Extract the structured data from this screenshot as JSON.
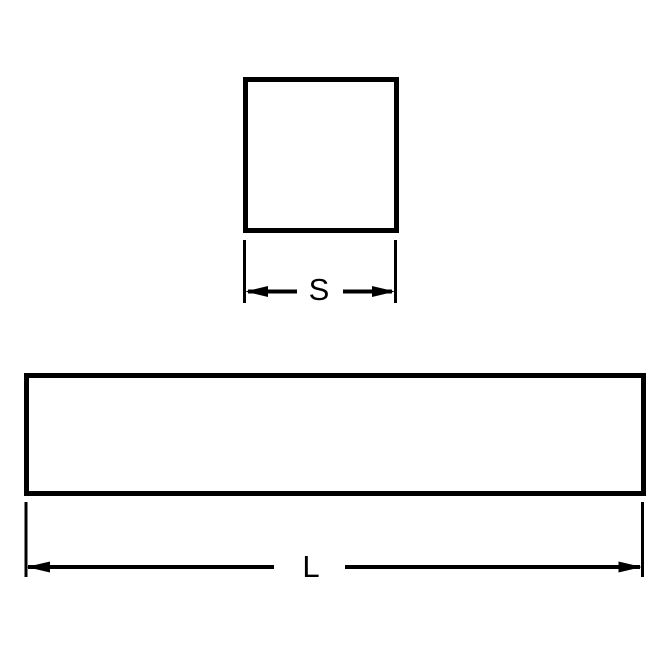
{
  "diagram": {
    "background_color": "#ffffff",
    "line_color": "#000000",
    "cross_section_view": {
      "shape": "square",
      "dimension_label": "S"
    },
    "length_view": {
      "shape": "rectangle",
      "dimension_label": "L"
    }
  }
}
